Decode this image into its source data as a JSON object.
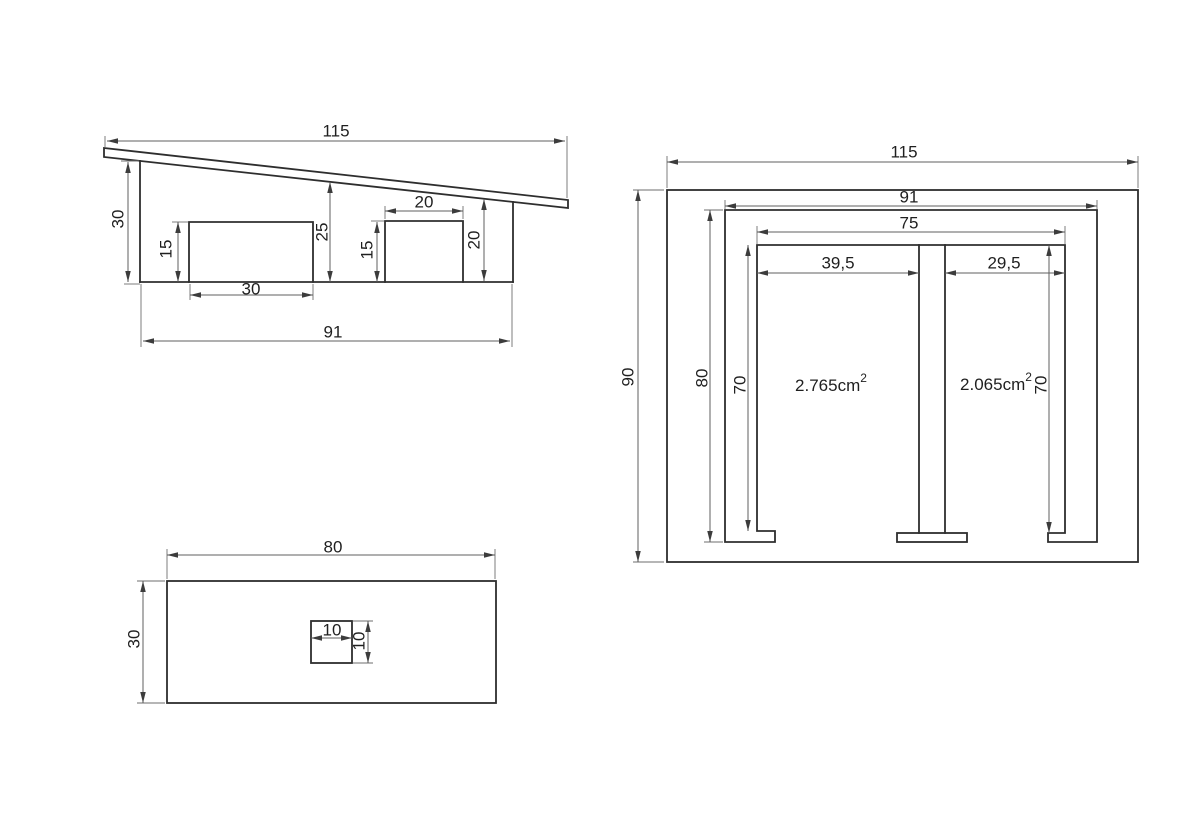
{
  "document": {
    "kind": "technical-drawing",
    "background": "#ffffff",
    "line_color": "#2e2e2e",
    "dimension_line_color": "#5f5f5f",
    "text_color": "#1f1f1f"
  },
  "views": {
    "side": {
      "name": "side-section-view",
      "dims": {
        "total_width": "115",
        "left_height": "30",
        "block_height": "15",
        "block_width": "30",
        "mid_height": "25",
        "channel_height": "15",
        "channel_width": "20",
        "right_height": "20",
        "base_width": "91"
      }
    },
    "front": {
      "name": "front-section-view",
      "dims": {
        "total_width": "115",
        "outer_width": "91",
        "inner_width": "75",
        "left_opening": "39,5",
        "right_opening": "29,5",
        "total_height": "90",
        "inner_height": "80",
        "left_chamber_height": "70",
        "right_chamber_height": "70"
      },
      "areas": {
        "left": {
          "value": "2.765cm",
          "sup": "2"
        },
        "right": {
          "value": "2.065cm",
          "sup": "2"
        }
      }
    },
    "bottom": {
      "name": "bottom-plate-view",
      "dims": {
        "width": "80",
        "height": "30",
        "hole_width": "10",
        "hole_height": "10"
      }
    }
  }
}
